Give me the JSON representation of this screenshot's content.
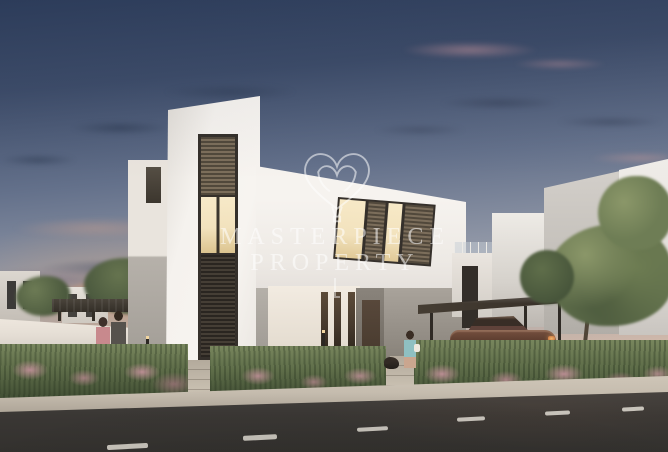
{
  "scene": {
    "description": "Dusk 3D architectural rendering of a modern white two-storey villa with louvred windows, landscaped flowering frontage, a carport with a parked dark bronze car, neighbouring white villas, trees, pedestrians on the sidewalk and an asphalt road with dashed lane markings in the foreground.",
    "time_of_day": "dusk"
  },
  "watermark": {
    "logo": "heart-balloon-logo",
    "brand_line1": "MASTERPIECE",
    "brand_line2": "PROPERTY",
    "color": "#ffffff"
  },
  "colors": {
    "sky-top": "#2e3e5c",
    "horizon": "#e3c2ab",
    "villa-white": "#f5f2ee",
    "villa-gray": "#938d85",
    "wall": "#e6dfd6",
    "louver": "#7c6e5b",
    "louver-dark": "#453e35",
    "window-warm": "#f2e2bd",
    "frame": "#35302b",
    "door": "#46392d",
    "hedge": "#5d6c48",
    "flower": "#c3949e",
    "tree": "#64734e",
    "trunk": "#4a4034",
    "car": "#5a3b2e",
    "carport": "#453d33",
    "sidewalk": "#c6bdaf",
    "road": "#3a3734"
  }
}
